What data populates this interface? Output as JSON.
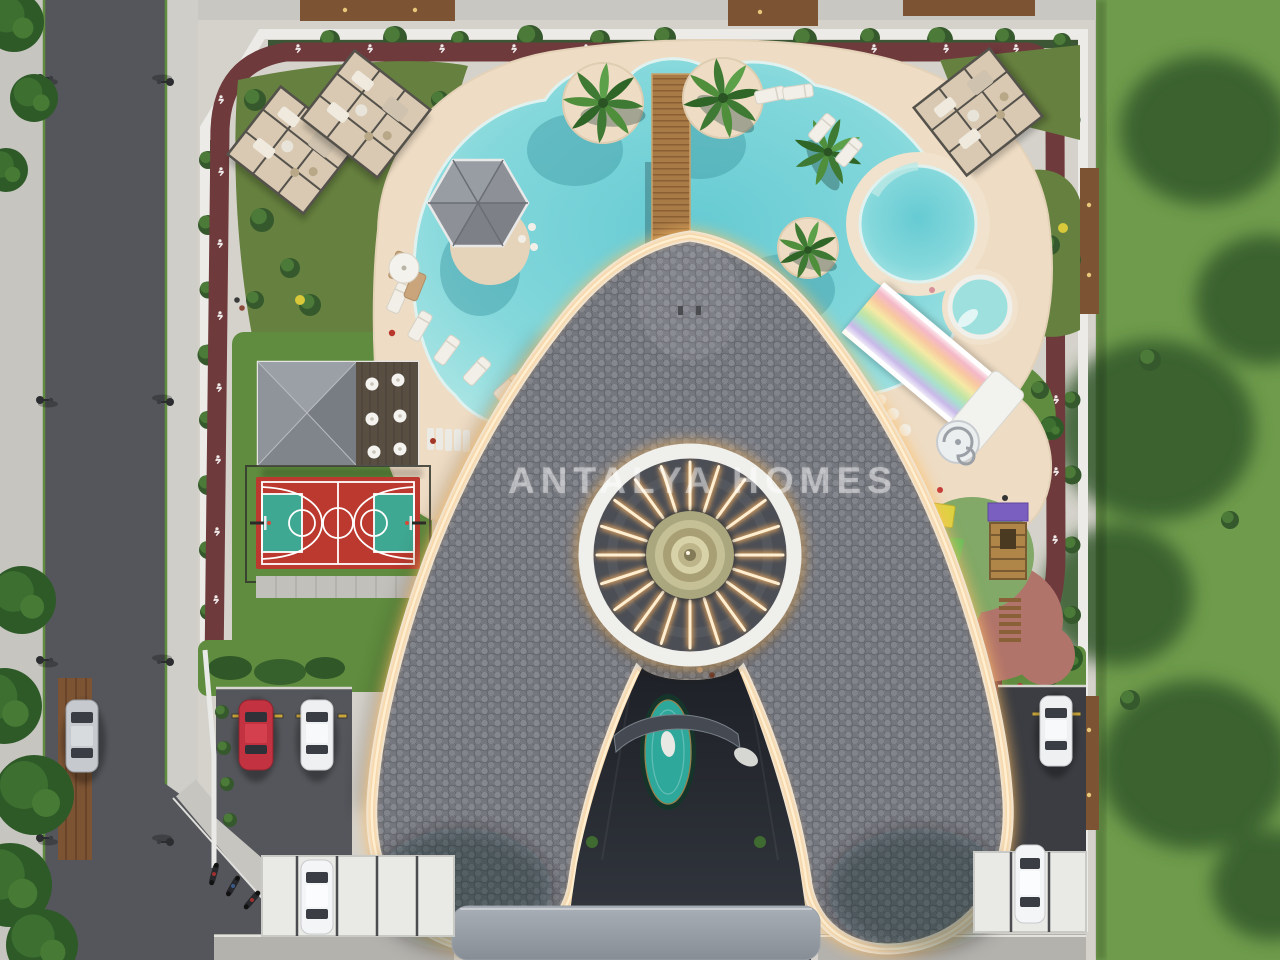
{
  "scene": {
    "watermark": "ANTALYA HOMES",
    "view": "top-down aerial 3D render",
    "description": "Aerial rendering of an A-shaped residential apartment block with LED-lit roof edges, circular skylight crown, landscaped garden with pools and sport amenities"
  },
  "colors": {
    "lawn": "#6f9c4c",
    "lawn_shadow": "#33592b",
    "site_concrete": "#d5d2cb",
    "sidewalk": "#c6c5c0",
    "road_asphalt": "#54565b",
    "wall_white": "#ecebe8",
    "wood_brown": "#7c5434",
    "hedge_green": "#35592c",
    "garden_olive": "#66803f",
    "grass_green": "#5f8c3e",
    "pool_water": "#66cbd3",
    "pool_water_edge": "#b7e9e7",
    "pool_deck": "#eedcc4",
    "track_maroon": "#6e3a3c",
    "court_red": "#bb392e",
    "court_key_teal": "#3fa892",
    "roof_gray": "#75777e",
    "roof_tile": "#868890",
    "edge_white": "#efefec",
    "led_line": "#ffefd2",
    "led_glow": "#ffc069",
    "entrance_dark": "#24272d",
    "fountain_teal": "#2fa89c",
    "canopy_gray": "#9aa0a8",
    "carport_white": "#e9e9e6",
    "playground_rubber": "#82a967",
    "playground_paving": "#b1746a",
    "cabana_gray": "#8d9197",
    "car_red": "#c23240",
    "car_white": "#eef0f1",
    "car_silver": "#c6c9cd",
    "gold_center": "#c6c097",
    "slide_stripes": [
      "#ffffff",
      "#f4b8c8",
      "#f8c8a0",
      "#f6e9a5",
      "#c2e5a5",
      "#a8e0d0",
      "#c9b9e9",
      "#ffffff"
    ]
  },
  "site": {
    "building": "A-shaped residential block with glowing roof edge strips and circular skylight crown",
    "amenities": [
      "free-form swimming pool",
      "round pool",
      "kids splash pool",
      "rainbow waterslide",
      "spiral slide stair",
      "wooden pool bridge",
      "hexagonal cabana",
      "sun loungers",
      "lounge pergolas",
      "restaurant terrace",
      "basketball court",
      "children playground",
      "jogging track",
      "entrance fountain",
      "parking lot",
      "carports"
    ],
    "vehicles": {
      "red_cars": 1,
      "white_cars": 4,
      "silver_cars": 1,
      "motorcycles": 3
    }
  }
}
